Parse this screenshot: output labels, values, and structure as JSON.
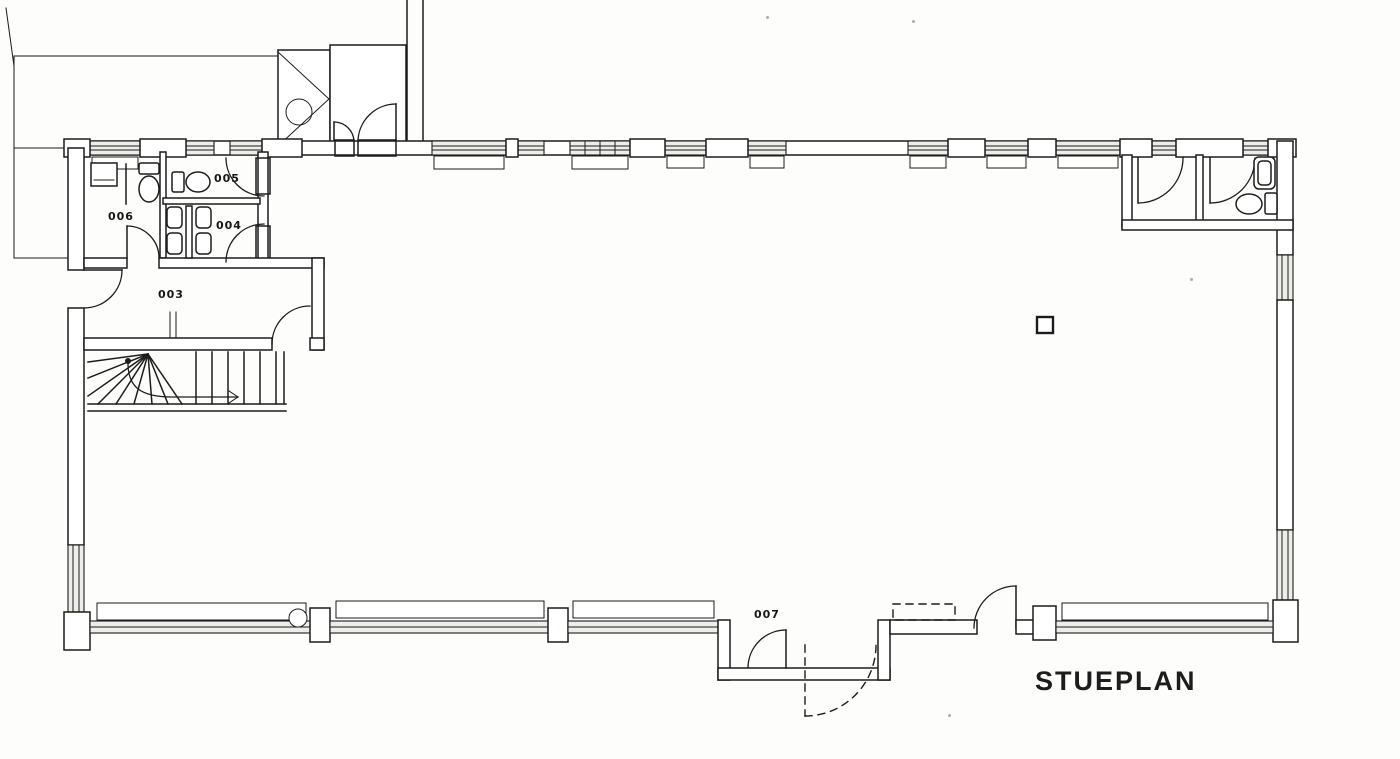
{
  "title": {
    "text": "STUEPLAN"
  },
  "rooms": [
    {
      "id": "003",
      "label": "003",
      "type": "hall-entry"
    },
    {
      "id": "004",
      "label": "004",
      "type": "toilet-urinals"
    },
    {
      "id": "005",
      "label": "005",
      "type": "toilet"
    },
    {
      "id": "006",
      "label": "006",
      "type": "toilet-sink"
    },
    {
      "id": "007",
      "label": "007",
      "type": "entrance-vestibule"
    }
  ],
  "symbols": {
    "hatched_area": "hatched-roof-terrace-area",
    "shower": "shower-cabin-with-drain-circle",
    "stairs": "winder-stair-with-walking-line-and-arrow",
    "toilet_count": 3,
    "sink_count": 2,
    "urinal_count": 4,
    "square_column_count": 1,
    "round_column_count": 1,
    "solid_door_count": 10,
    "dashed_door_count": 1,
    "window_band": "double-line-glazing-with-sill"
  },
  "colors": {
    "line": "#1c1c1c",
    "paper": "#fdfdfc",
    "glazing_fill": "#ededea"
  }
}
